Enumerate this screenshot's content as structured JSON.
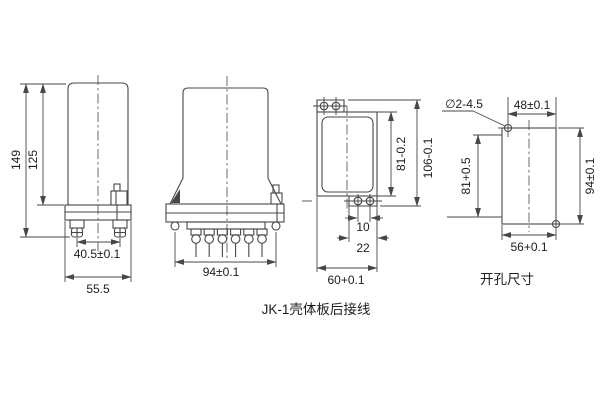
{
  "drawing": {
    "caption": "JK-1壳体板后接线",
    "line_color": "#474747",
    "views": {
      "side": {
        "dim_overall_height": "149",
        "dim_body_height": "125",
        "dim_terminal_pitch": "40.5±0.1",
        "dim_overall_width": "55.5"
      },
      "front": {
        "dim_mounting_span": "94±0.1"
      },
      "rear_plate": {
        "dim_plate_height": "81-0.2",
        "dim_overall_height": "106-0.1",
        "dim_hole_pitch": "10",
        "dim_tab_width": "22",
        "dim_plate_width": "60+0.1"
      },
      "cutout": {
        "caption": "开孔尺寸",
        "hole_callout": "∅2-4.5",
        "dim_hole_offset_h": "48±0.1",
        "dim_opening_height": "81+0.5",
        "dim_hole_span_v": "94±0.1",
        "dim_opening_width": "56+0.1"
      }
    }
  }
}
